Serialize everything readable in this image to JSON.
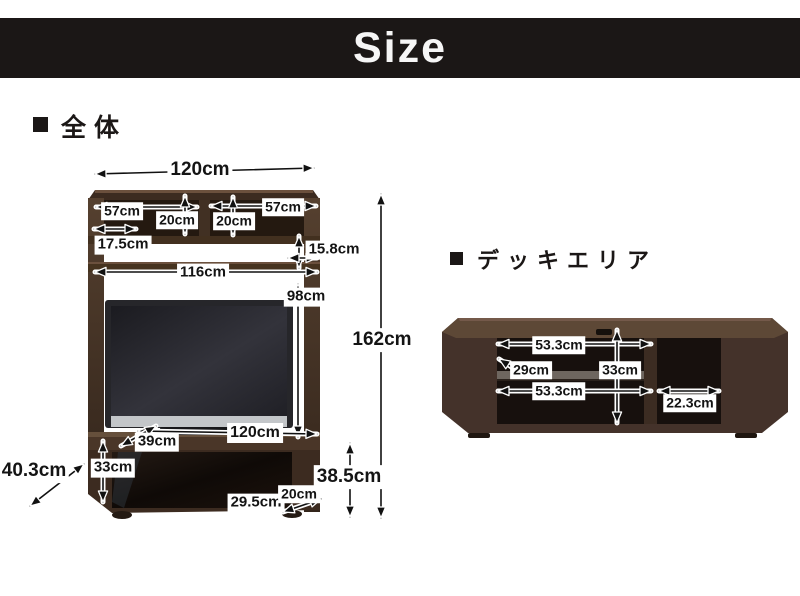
{
  "header": {
    "title": "Size"
  },
  "sections": {
    "overall_label": "全体",
    "deck_label": "デッキエリア"
  },
  "overall_dims": {
    "top_width": "120cm",
    "shelf_left_width": "57cm",
    "shelf_right_width": "57cm",
    "shelf_left_height": "20cm",
    "shelf_right_height": "20cm",
    "top_depth": "17.5cm",
    "side_gap": "15.8cm",
    "inner_width": "116cm",
    "tv_space_height": "98cm",
    "total_height": "162cm",
    "mid_width": "120cm",
    "shelf_depth": "39cm",
    "door_height": "33cm",
    "diagonal_depth": "40.3cm",
    "base_inner_width": "29.5cm",
    "base_depth": "20cm",
    "base_height": "38.5cm"
  },
  "deck_dims": {
    "top_inner_width": "53.3cm",
    "shelf_depth": "29cm",
    "inner_height": "33cm",
    "bottom_inner_width": "53.3cm",
    "right_inner_width": "22.3cm"
  },
  "colors": {
    "banner": "#1b1716",
    "wood": "#4a3729",
    "wood_dark": "#32241b",
    "wood_light": "#65503e",
    "interior_black": "#1a120d",
    "label_bg": "#ffffff",
    "label_text": "#141414"
  }
}
